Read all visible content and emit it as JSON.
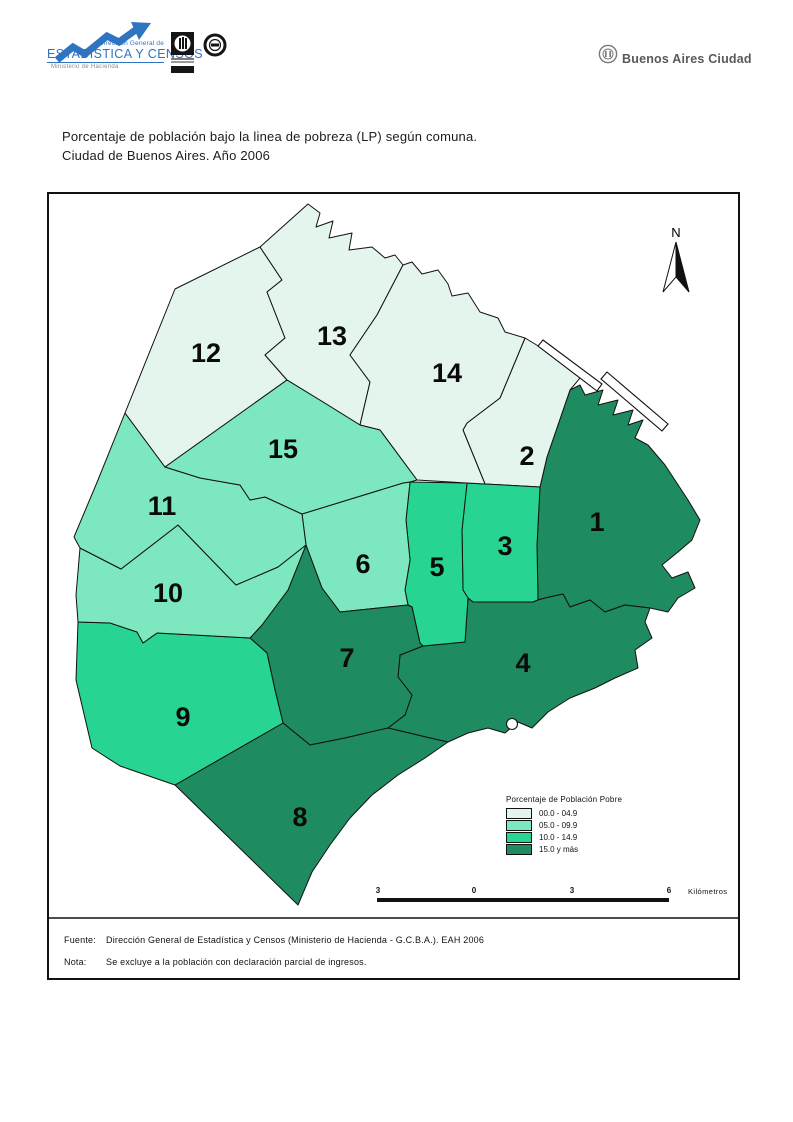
{
  "header": {
    "dg_top": "Dirección General de",
    "dg_main": "ESTADÍSTICA Y CENSOS",
    "dg_sub": "Ministerio de Hacienda",
    "city_brand": "Buenos Aires Ciudad"
  },
  "title": {
    "line1": "Porcentaje de población bajo la linea de pobreza (LP) según comuna.",
    "line2": "Ciudad de Buenos Aires. Año 2006"
  },
  "map": {
    "north_label": "N",
    "comunas": [
      {
        "num": "1",
        "cls": 4,
        "range": "15.0 y más",
        "label_x": 597,
        "label_y": 531,
        "points": "570,390 580,385 585,395 603,390 598,405 618,400 613,415 633,410 628,425 643,420 635,438 648,445 665,465 688,500 700,520 692,540 678,552 662,565 672,578 688,572 695,588 678,598 668,612 650,608 625,605 605,612 590,600 570,607 563,594 545,598 538,600 537,545 540,487 547,457"
      },
      {
        "num": "2",
        "cls": 1,
        "range": "00.0 - 04.9",
        "label_x": 527,
        "label_y": 465,
        "points": "525,338 545,350 585,372 570,390 547,457 540,487 485,484 463,430 467,423 500,398"
      },
      {
        "num": "3",
        "cls": 3,
        "range": "10.0 - 14.9",
        "label_x": 505,
        "label_y": 555,
        "points": "467,483 485,484 540,487 537,545 538,600 533,602 473,602 468,598 463,590 462,530"
      },
      {
        "num": "4",
        "cls": 4,
        "range": "15.0 y más",
        "label_x": 523,
        "label_y": 672,
        "points": "423,646 465,642 468,598 473,602 533,602 538,600 545,598 563,594 570,607 590,600 605,612 625,605 650,608 645,622 652,638 635,650 638,668 615,678 595,688 570,698 548,712 532,728 518,722 505,733 488,728 468,733 448,742 430,738 405,732 388,728 405,715 412,695 398,677 400,655"
      },
      {
        "num": "5",
        "cls": 3,
        "range": "10.0 - 14.9",
        "label_x": 437,
        "label_y": 576,
        "points": "410,482 467,483 462,530 463,590 468,598 465,642 423,646 420,643 412,607 408,605 405,590 410,560 406,520"
      },
      {
        "num": "6",
        "cls": 2,
        "range": "05.0 - 09.9",
        "label_x": 363,
        "label_y": 573,
        "points": "302,514 403,483 410,482 406,520 410,560 405,590 408,605 340,612 322,588 306,545"
      },
      {
        "num": "7",
        "cls": 4,
        "range": "15.0 y más",
        "label_x": 347,
        "label_y": 667,
        "points": "306,545 322,588 340,612 408,605 412,607 420,643 423,646 400,655 398,677 412,695 405,715 388,728 345,738 310,745 283,723 275,690 267,653 250,638 262,625 288,590"
      },
      {
        "num": "8",
        "cls": 4,
        "range": "15.0 y más",
        "label_x": 300,
        "label_y": 826,
        "points": "283,723 310,745 345,738 388,728 405,732 430,738 448,742 425,758 398,775 372,795 350,818 330,845 312,872 298,905 175,785"
      },
      {
        "num": "9",
        "cls": 3,
        "range": "10.0 - 14.9",
        "label_x": 183,
        "label_y": 726,
        "points": "78,622 110,623 137,632 143,643 157,633 250,638 267,653 275,690 283,723 175,785 120,766 92,748 76,680"
      },
      {
        "num": "10",
        "cls": 2,
        "range": "05.0 - 09.9",
        "label_x": 168,
        "label_y": 602,
        "points": "80,548 121,569 178,525 236,585 278,567 306,545 288,590 262,625 250,638 157,633 143,643 137,632 110,623 78,622 76,595"
      },
      {
        "num": "11",
        "cls": 2,
        "range": "05.0 - 09.9",
        "label_x": 162,
        "label_y": 515,
        "points": "125,413 165,467 200,478 240,485 250,500 265,497 302,514 306,545 278,567 236,585 178,525 121,569 80,548 74,537 98,480"
      },
      {
        "num": "12",
        "cls": 1,
        "range": "00.0 - 04.9",
        "label_x": 206,
        "label_y": 362,
        "points": "175,289 260,247 282,280 267,292 285,338 265,355 287,380 165,467 125,413"
      },
      {
        "num": "13",
        "cls": 1,
        "range": "00.0 - 04.9",
        "label_x": 332,
        "label_y": 345,
        "points": "260,247 308,204 320,213 316,227 333,221 329,238 352,233 349,250 372,247 385,258 395,255 403,265 377,315 350,355 370,382 363,412 360,425 323,402 287,380 265,355 285,338 267,292 282,280"
      },
      {
        "num": "14",
        "cls": 1,
        "range": "00.0 - 04.9",
        "label_x": 447,
        "label_y": 382,
        "points": "403,265 412,262 422,274 438,270 448,284 452,296 468,293 480,312 498,318 505,332 525,338 500,398 467,423 463,430 485,484 467,483 417,480 380,430 360,425 363,412 370,382 350,355 377,315"
      },
      {
        "num": "15",
        "cls": 2,
        "range": "05.0 - 09.9",
        "label_x": 283,
        "label_y": 458,
        "points": "165,467 287,380 323,402 360,425 380,430 417,480 410,482 403,483 302,514 265,497 250,500 240,485 200,478"
      }
    ]
  },
  "legend": {
    "title": "Porcentaje de Población Pobre",
    "items": [
      {
        "label": "00.0 - 04.9",
        "color": "#E3F5EC"
      },
      {
        "label": "05.0 - 09.9",
        "color": "#7DE8C0"
      },
      {
        "label": "10.0 - 14.9",
        "color": "#27D492"
      },
      {
        "label": "15.0 y más",
        "color": "#1F8B60"
      }
    ]
  },
  "scalebar": {
    "labels": [
      "3",
      "0",
      "3",
      "6"
    ],
    "unit": "Kilómetros"
  },
  "footer": {
    "fuente_label": "Fuente:",
    "fuente_text": "Dirección General de Estadística y Censos (Ministerio de Hacienda - G.C.B.A.). EAH 2006",
    "nota_label": "Nota:",
    "nota_text": "Se excluye a la población con declaración parcial de ingresos."
  }
}
